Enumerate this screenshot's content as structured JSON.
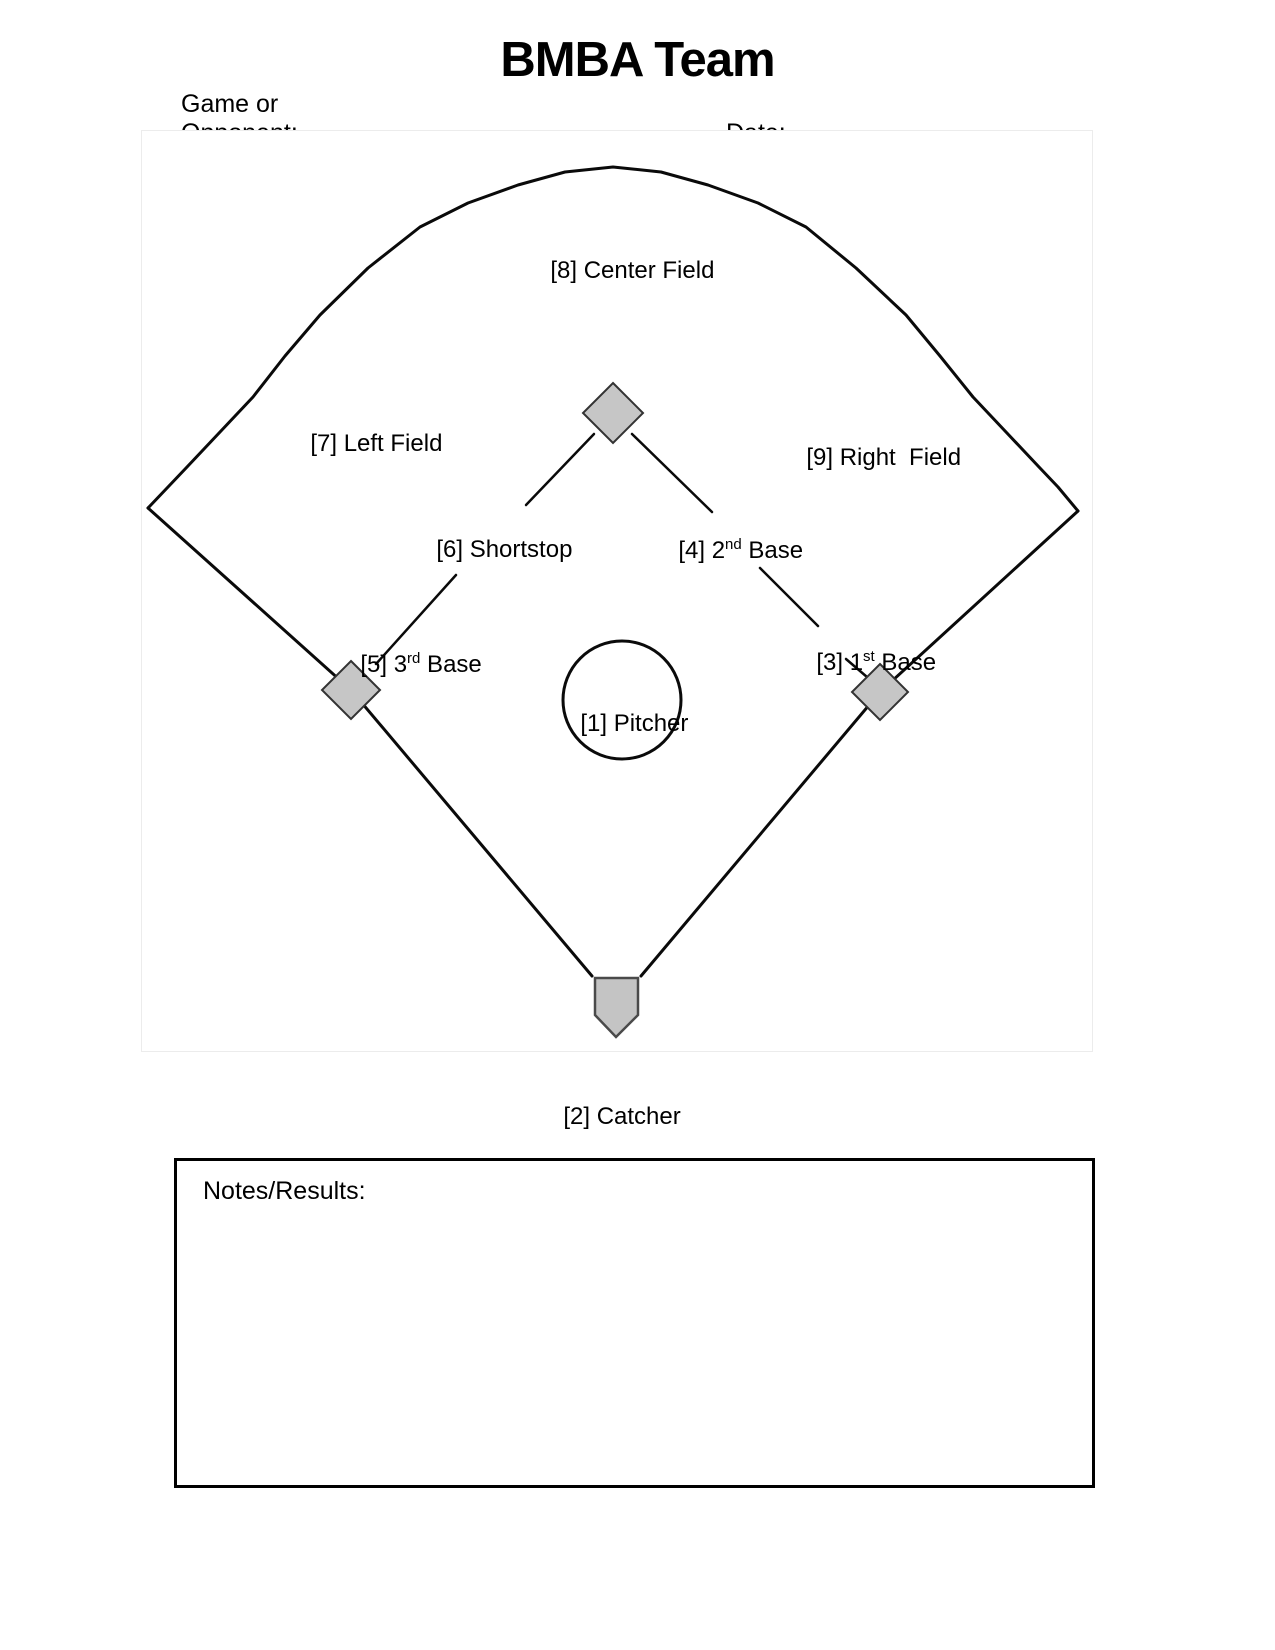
{
  "title": "BMBA Team",
  "header_form": {
    "game_or_label": "Game or",
    "opponent_label": "Opponent:",
    "date_label": "Date:",
    "opponent_value": "",
    "date_value": ""
  },
  "field": {
    "positions": {
      "pitcher": {
        "p1": "[1] Pitcher",
        "sup": "",
        "p2": ""
      },
      "catcher": {
        "p1": "[2] Catcher",
        "sup": "",
        "p2": ""
      },
      "first_base": {
        "p1": "[3] 1",
        "sup": "st",
        "p2": " Base"
      },
      "second_base": {
        "p1": "[4] 2",
        "sup": "nd",
        "p2": " Base"
      },
      "third_base": {
        "p1": "[5] 3",
        "sup": "rd",
        "p2": " Base"
      },
      "shortstop": {
        "p1": "[6] Shortstop",
        "sup": "",
        "p2": ""
      },
      "left_field": {
        "p1": "[7] Left Field",
        "sup": "",
        "p2": ""
      },
      "center_field": {
        "p1": "[8] Center Field",
        "sup": "",
        "p2": ""
      },
      "right_field": {
        "p1": "[9] Right  Field",
        "sup": "",
        "p2": ""
      }
    }
  },
  "notes": {
    "label": "Notes/Results:",
    "value": ""
  },
  "colors": {
    "line": "#0a0a0a",
    "base_fill": "#c6c6c6",
    "base_stroke": "#333333",
    "home_plate_fill": "#c4c4c4",
    "field_edge": "#ececec",
    "text": "#000000"
  }
}
